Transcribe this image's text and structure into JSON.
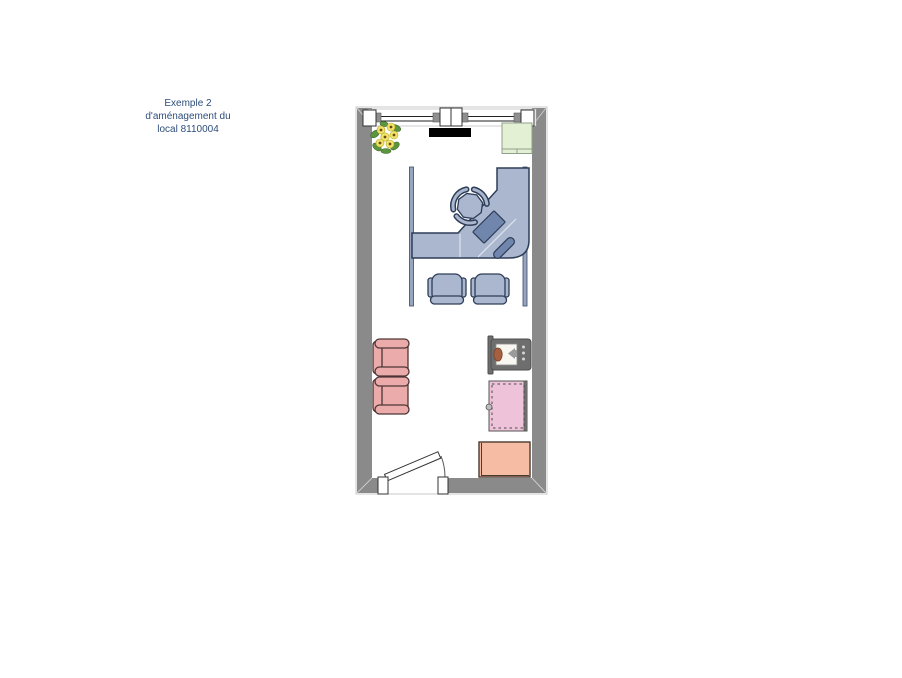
{
  "label": {
    "line1": "Exemple 2",
    "line2": "d'aménagement du",
    "line3": "local 8110004"
  },
  "colors": {
    "wall": "#8a8a8a",
    "wall_edge": "#c9c9c9",
    "room_floor": "#ffffff",
    "wallboard": "#000000",
    "cabinet_fill": "#e3f0d4",
    "cabinet_stroke": "#8fa08a",
    "desk_fill": "#aab7cf",
    "desk_stroke": "#2e3d58",
    "desk_accent": "#7186ac",
    "chair_fill": "#aab7cf",
    "armchair_fill": "#ecabab",
    "armchair_stroke": "#4d3535",
    "tv_body": "#6e6e6e",
    "tv_speaker": "#a5613f",
    "board_fill": "#eec2d8",
    "table_fill": "#f7bca4",
    "table_stroke": "#4a3a30",
    "plant_flower": "#f2e468",
    "plant_leaf": "#5c9440",
    "label_text": "#2e4d7b"
  },
  "furniture_items": [
    "window with posts",
    "flower plant",
    "wall display strip",
    "storage cabinet",
    "partition panels",
    "corner workstation desk",
    "desktop monitor",
    "phone handset",
    "office chair",
    "visitor chair",
    "visitor chair",
    "armchair",
    "armchair",
    "wall-mounted tv",
    "pin board",
    "side table",
    "door with swing arc"
  ]
}
